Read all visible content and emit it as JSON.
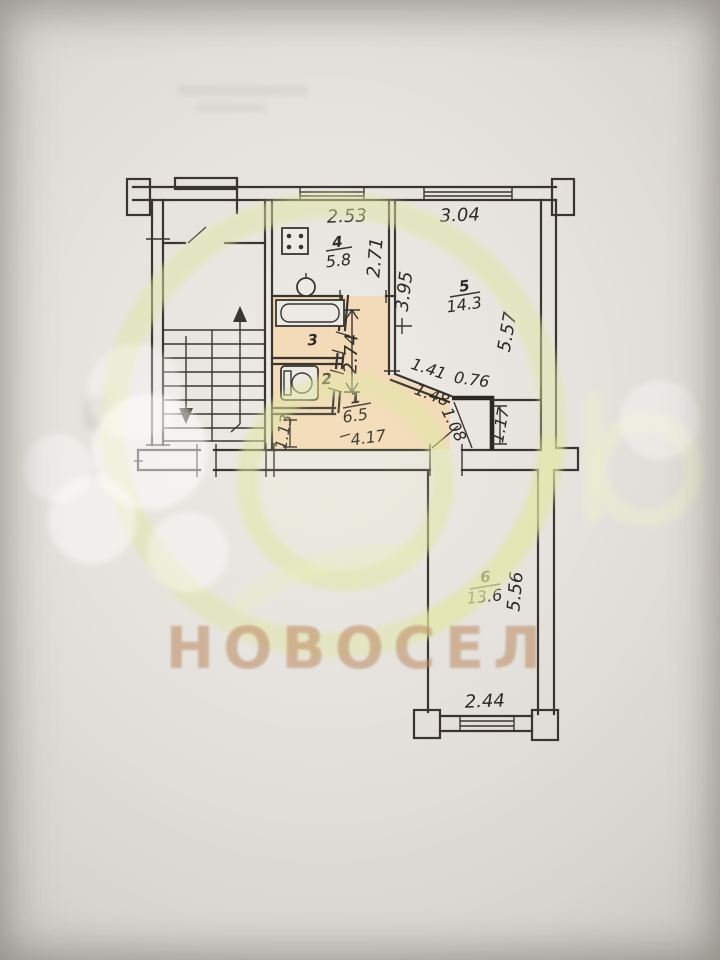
{
  "watermark": {
    "agency": "НОВОСЕЛ"
  },
  "rooms": {
    "hall": {
      "number": "1",
      "area": "6.5"
    },
    "toilet": {
      "number": "2"
    },
    "bath": {
      "number": "3"
    },
    "kitchen": {
      "number": "4",
      "area": "5.8"
    },
    "living": {
      "number": "5",
      "area": "14.3"
    },
    "bedroom": {
      "number": "6",
      "area": "13.6"
    }
  },
  "dimensions": {
    "kitchen_width": "2.53",
    "kitchen_depth": "2.71",
    "living_width": "3.04",
    "living_left_depth": "3.95",
    "living_depth": "5.57",
    "hall_height": "2.74",
    "hall_width": "4.17",
    "hall_diag_upper": "1.41",
    "hall_diag_lower": "1.48",
    "closet_width": "0.76",
    "closet_diag": "1.08",
    "closet_side": "1.17",
    "passage_width": "1.13",
    "bedroom_depth": "5.56",
    "bedroom_width": "2.44"
  },
  "colors": {
    "highlight_peach": "#f4d7b2",
    "watermark_yellow": "#e2e7a6",
    "brand_tan": "#bd8a64",
    "line": "#3a352e"
  }
}
